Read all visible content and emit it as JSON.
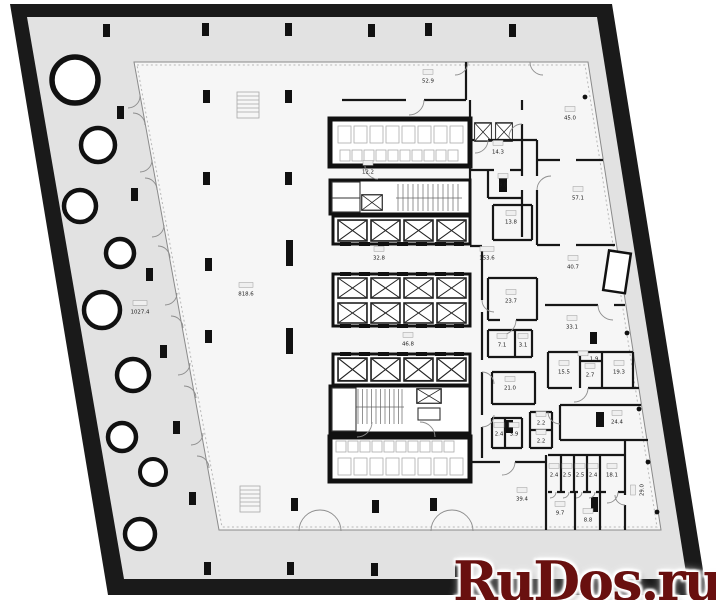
{
  "watermark": {
    "text": "RuDos.ru",
    "color": "#69100f"
  },
  "colors": {
    "outer_wall": "#1a1a1a",
    "terrace": "#e2e2e2",
    "floor": "#f6f6f6",
    "watermark_red": "#69100f"
  },
  "plan": {
    "big_labels": {
      "open_space_area": "818.6",
      "terrace_area": "1027.4"
    },
    "rooms": [
      {
        "area": "818.6",
        "x": 246,
        "y": 293
      },
      {
        "area": "1027.4",
        "x": 140,
        "y": 311
      },
      {
        "area": "52.9",
        "x": 428,
        "y": 80
      },
      {
        "area": "45.0",
        "x": 570,
        "y": 117
      },
      {
        "area": "14.3",
        "x": 498,
        "y": 151
      },
      {
        "area": "12.2",
        "x": 368,
        "y": 171
      },
      {
        "area": "9.0",
        "x": 503,
        "y": 184
      },
      {
        "area": "57.1",
        "x": 578,
        "y": 197
      },
      {
        "area": "13.8",
        "x": 511,
        "y": 221
      },
      {
        "area": "32.8",
        "x": 379,
        "y": 257
      },
      {
        "area": "153.6",
        "x": 487,
        "y": 257
      },
      {
        "area": "40.7",
        "x": 573,
        "y": 266
      },
      {
        "area": "23.7",
        "x": 511,
        "y": 300
      },
      {
        "area": "33.1",
        "x": 572,
        "y": 326
      },
      {
        "area": "46.8",
        "x": 408,
        "y": 343
      },
      {
        "area": "7.1",
        "x": 502,
        "y": 344
      },
      {
        "area": "3.1",
        "x": 523,
        "y": 344
      },
      {
        "area": "1.9",
        "x": 594,
        "y": 358,
        "inline": true
      },
      {
        "area": "15.5",
        "x": 564,
        "y": 371
      },
      {
        "area": "2.7",
        "x": 590,
        "y": 374
      },
      {
        "area": "19.3",
        "x": 619,
        "y": 371
      },
      {
        "area": "21.0",
        "x": 510,
        "y": 387
      },
      {
        "area": "24.4",
        "x": 617,
        "y": 421
      },
      {
        "area": "2.2",
        "x": 541,
        "y": 422
      },
      {
        "area": "2.4",
        "x": 499,
        "y": 433
      },
      {
        "area": "3.9",
        "x": 514,
        "y": 433
      },
      {
        "area": "2.2",
        "x": 541,
        "y": 440
      },
      {
        "area": "2.4",
        "x": 554,
        "y": 474
      },
      {
        "area": "2.5",
        "x": 567,
        "y": 474
      },
      {
        "area": "2.5",
        "x": 580,
        "y": 474
      },
      {
        "area": "2.4",
        "x": 593,
        "y": 474
      },
      {
        "area": "18.1",
        "x": 612,
        "y": 474
      },
      {
        "area": "29.0",
        "x": 641,
        "y": 490,
        "rot": -90
      },
      {
        "area": "39.4",
        "x": 522,
        "y": 498
      },
      {
        "area": "9.7",
        "x": 560,
        "y": 512
      },
      {
        "area": "8.8",
        "x": 588,
        "y": 519
      }
    ]
  }
}
